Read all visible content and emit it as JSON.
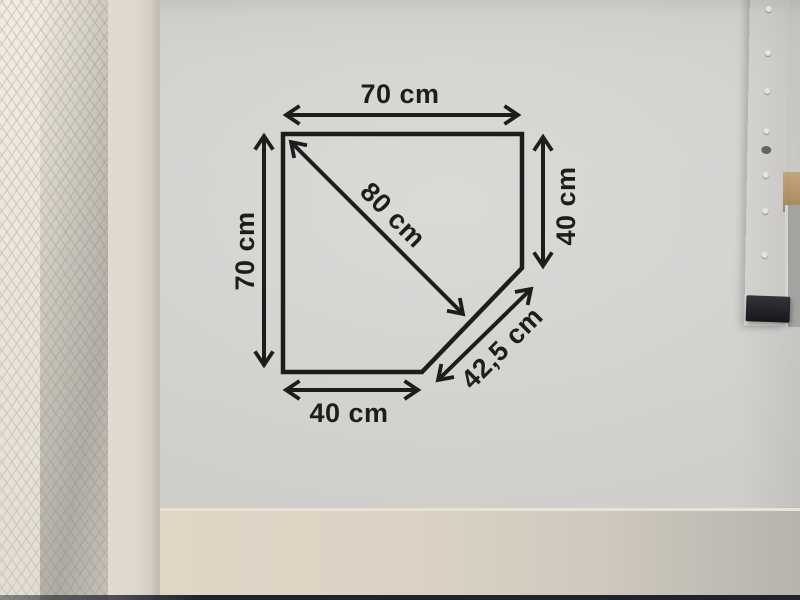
{
  "diagram": {
    "top": "70 cm",
    "left": "70 cm",
    "right": "40 cm",
    "bottom": "40 cm",
    "diagonal": "80 cm",
    "cut": "42,5 cm"
  },
  "colors": {
    "ink": "#1d1d1b",
    "paper": "#d7d5d2",
    "wall": "#ece7de",
    "table_surface": "#dbd1c2",
    "metal_rail": "#aaaaa8",
    "rail_cap": "#232329",
    "bottom_strip": "#1e2330"
  }
}
